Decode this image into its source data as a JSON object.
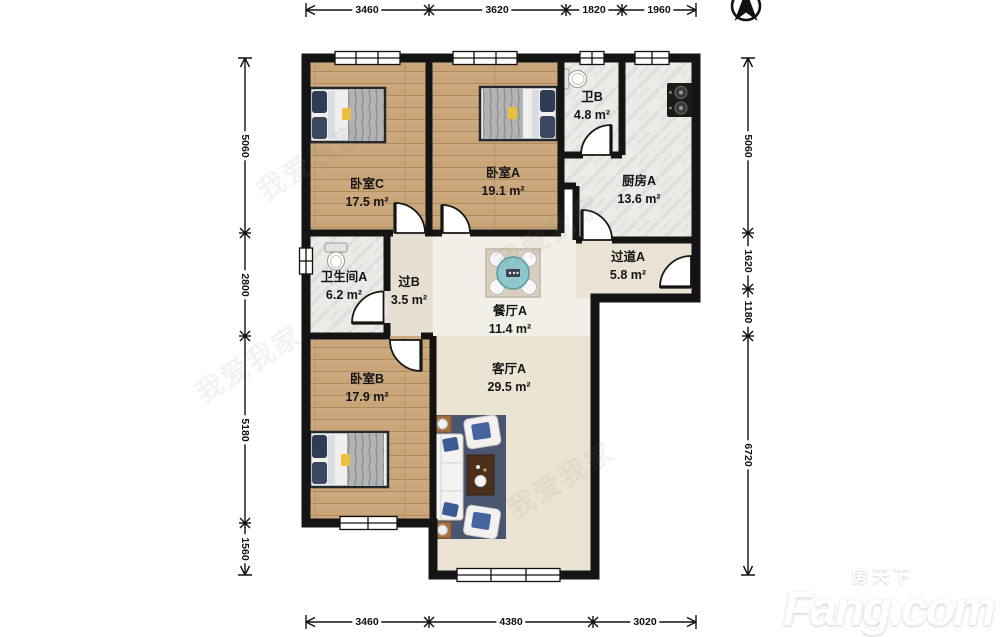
{
  "plan": {
    "rooms": [
      {
        "name": "卧室C",
        "area": "17.5 m²"
      },
      {
        "name": "卧室A",
        "area": "19.1 m²"
      },
      {
        "name": "卫B",
        "area": "4.8 m²"
      },
      {
        "name": "厨房A",
        "area": "13.6 m²"
      },
      {
        "name": "卫生间A",
        "area": "6.2 m²"
      },
      {
        "name": "过B",
        "area": "3.5 m²"
      },
      {
        "name": "餐厅A",
        "area": "11.4 m²"
      },
      {
        "name": "过道A",
        "area": "5.8 m²"
      },
      {
        "name": "卧室B",
        "area": "17.9 m²"
      },
      {
        "name": "客厅A",
        "area": "29.5 m²"
      }
    ],
    "dimensions": {
      "top": [
        "3460",
        "3620",
        "1820",
        "1960"
      ],
      "bottom": [
        "3460",
        "4380",
        "3020"
      ],
      "left": [
        "5060",
        "2800",
        "5180",
        "1560"
      ],
      "right": [
        "5060",
        "1620",
        "1180",
        "6720"
      ]
    }
  },
  "watermark": {
    "brand_cn": "房天下",
    "brand_en": "Fang.com",
    "agency": "我爱我家"
  },
  "colors": {
    "wall": "#141414",
    "wood_floor": "#c9a578",
    "tile_floor": "#ebebe8",
    "living_floor": "#ece4d2",
    "dining_floor": "#f2efe8",
    "rug_blue": "#4a5670",
    "table_teal": "#8ec7cd"
  }
}
